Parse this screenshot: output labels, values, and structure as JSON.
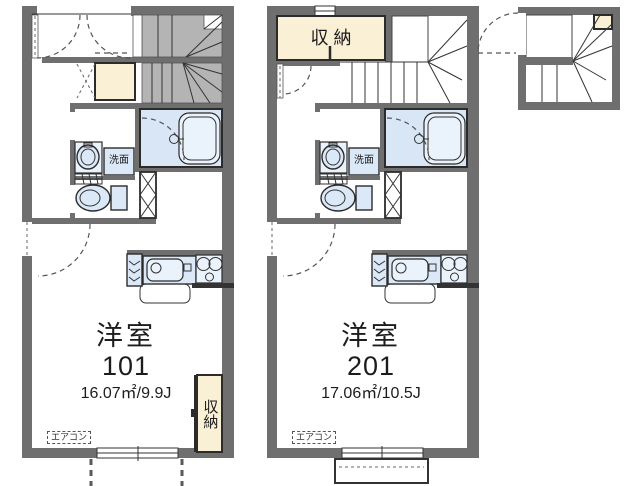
{
  "floorplan": {
    "units": [
      {
        "name": "unit-101",
        "room_label": "洋室",
        "room_number": "101",
        "area": "16.07㎡/9.9J",
        "closet_label": "収納",
        "washstand_label": "洗面",
        "aircon_label": "エアコン"
      },
      {
        "name": "unit-201",
        "room_label": "洋室",
        "room_number": "201",
        "area": "17.06㎡/10.5J",
        "closet_label": "収納",
        "washstand_label": "洗面",
        "aircon_label": "エアコン"
      }
    ],
    "colors": {
      "wall_gray": "#6f6f6f",
      "stair_gray": "#b4b4b4",
      "fixture_blue": "#dbe8f7",
      "bath_blue": "#d9e6f6",
      "closet_cream": "#faf0d6",
      "line_dark": "#333333"
    }
  }
}
